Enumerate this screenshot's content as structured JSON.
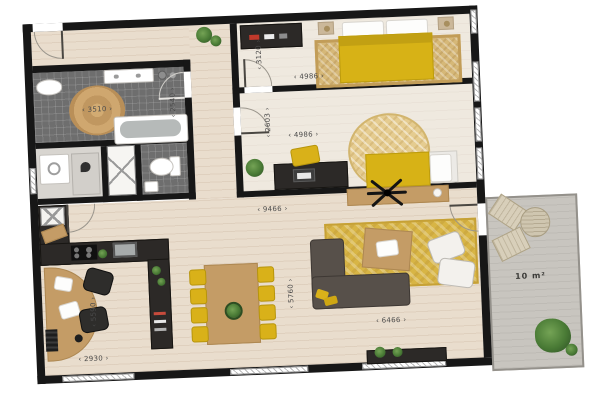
{
  "floorplan": {
    "terrace_area_label": "10 m²",
    "dims": {
      "bathroom_w": "3510",
      "bathroom_h": "2540",
      "bedroom1_w": "4986",
      "bedroom1_h": "3120",
      "bedroom2_w": "4986",
      "bedroom2_h": "2603",
      "living_w": "9466",
      "dining_h": "5760",
      "living_bottom_w": "6466",
      "office_w": "2930",
      "office_h": "5590"
    },
    "colors": {
      "wall": "#171717",
      "wood_floor": "#e9ddcd",
      "bathroom_tile": "#6e6e6e",
      "accent_yellow": "#d7b216",
      "terrace_gray": "#c8c5bf",
      "rug_gold": "#d6b878"
    }
  }
}
